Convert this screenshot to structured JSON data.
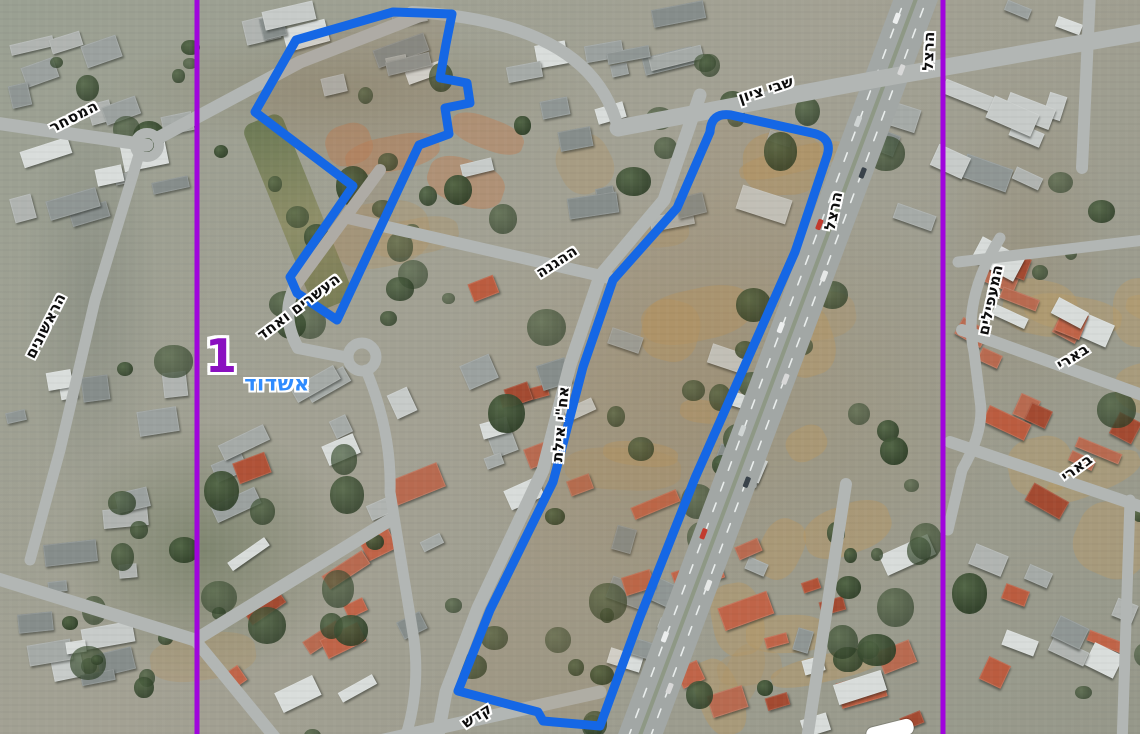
{
  "map": {
    "city_label": {
      "text": "אשדוד",
      "x": 277,
      "y": 384,
      "color": "#2f8bfe"
    },
    "region_label": {
      "text": "1",
      "x": 221,
      "y": 356,
      "color": "#8a10c0"
    },
    "street_labels": [
      {
        "text": "המסחר",
        "x": 74,
        "y": 117,
        "rot": -27
      },
      {
        "text": "הראשונים",
        "x": 46,
        "y": 326,
        "rot": -63
      },
      {
        "text": "שבי ציון",
        "x": 766,
        "y": 90,
        "rot": -18
      },
      {
        "text": "הרצל",
        "x": 929,
        "y": 51,
        "rot": -88
      },
      {
        "text": "הרצל",
        "x": 834,
        "y": 211,
        "rot": -78
      },
      {
        "text": "העשרים ואחד",
        "x": 299,
        "y": 307,
        "rot": -37
      },
      {
        "text": "ההגנה",
        "x": 557,
        "y": 262,
        "rot": -33
      },
      {
        "text": "אח\"י אילת",
        "x": 561,
        "y": 424,
        "rot": -85
      },
      {
        "text": "קדש",
        "x": 477,
        "y": 716,
        "rot": -32
      },
      {
        "text": "המעפילים",
        "x": 991,
        "y": 300,
        "rot": -78
      },
      {
        "text": "בארי",
        "x": 1073,
        "y": 357,
        "rot": -32
      },
      {
        "text": "בארי",
        "x": 1077,
        "y": 468,
        "rot": -36
      }
    ],
    "zones": [
      {
        "name": "school-campus-outline",
        "fill": "rgba(150,100,60,0.12)",
        "path": "M 393,12 L 452,14 L 446,44 L 440,78 L 467,83 L 470,103 L 445,108 L 449,134 L 419,145 L 337,320 L 297,293 L 290,277 L 353,186 L 255,112 L 296,40 Z"
      },
      {
        "name": "herzl-strip-outline",
        "fill": "rgba(160,120,70,0.14)",
        "path": "M 710,132 Q 711,112 731,115 L 812,133 Q 833,137 827,156 L 795,252 L 695,478 L 640,617 L 600,726 L 543,721 L 538,712 L 458,691 L 490,610 L 553,482 L 557,467 L 583,367 L 613,280 L 677,208 Z"
      }
    ],
    "zone_outline_color": "#1567E5",
    "section_lines": {
      "color": "#A004DC",
      "x_positions": [
        197,
        943
      ]
    }
  }
}
